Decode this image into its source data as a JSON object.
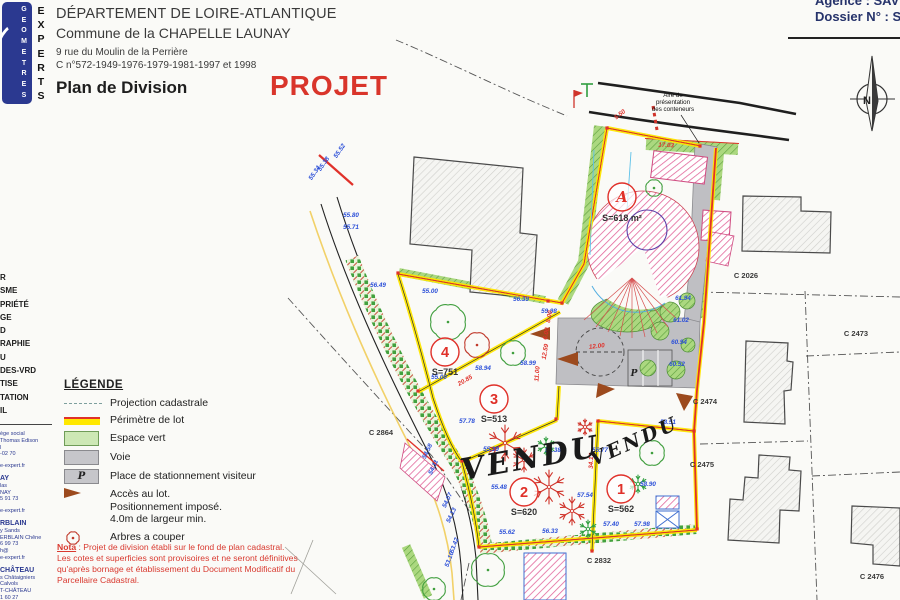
{
  "header": {
    "line1": "DÉPARTEMENT DE LOIRE-ATLANTIQUE",
    "line2": "Commune de la CHAPELLE LAUNAY",
    "line3": "9 rue du Moulin de la Perrière",
    "line4": "C n°572-1949-1976-1979-1981-1997 et 1998",
    "title": "Plan de Division",
    "stamp": "PROJET"
  },
  "corner": {
    "agence": "Agence : SAV",
    "dossier": "Dossier N° : S"
  },
  "logo": {
    "word1": "GEOMETRES",
    "word2": "EXPERTS"
  },
  "sidebar": {
    "services": [
      "R",
      "SME",
      "PRIÉTÉ",
      "GE",
      "D",
      "RAPHIE",
      "U",
      "DES-VRD",
      "TISE",
      "TATION",
      "IL"
    ],
    "addresses": [
      {
        "t": "ège social"
      },
      {
        "t": "Thomas Edison"
      },
      {
        "t": "l"
      },
      {
        "t": "-02 70"
      },
      {
        "t": ""
      },
      {
        "t": "e-expert.fr"
      },
      {
        "t": "AY",
        "b": true
      },
      {
        "t": "las"
      },
      {
        "t": "NAY"
      },
      {
        "t": "5 91 73"
      },
      {
        "t": ""
      },
      {
        "t": "e-expert.fr"
      },
      {
        "t": "RBLAIN",
        "b": true
      },
      {
        "t": "y Sands"
      },
      {
        "t": "ERBLAIN Chêne"
      },
      {
        "t": "6 99 73"
      },
      {
        "t": "h@"
      },
      {
        "t": "e-expert.fr"
      },
      {
        "t": "CHÂTEAU",
        "b": true
      },
      {
        "t": "s Châtaigniers"
      },
      {
        "t": "Calvols"
      },
      {
        "t": "T-CHÂTEAU"
      },
      {
        "t": "1 60 27"
      },
      {
        "t": "@"
      },
      {
        "t": "expert.fr"
      }
    ]
  },
  "legend": {
    "title": "LÉGENDE",
    "items": [
      {
        "symbol": "dash",
        "label": "Projection cadastrale"
      },
      {
        "symbol": "yellow",
        "label": "Périmètre de lot"
      },
      {
        "symbol": "green",
        "label": "Espace vert"
      },
      {
        "symbol": "gray",
        "label": "Voie"
      },
      {
        "symbol": "park",
        "symbol_text": "P",
        "label": "Place de stationnement visiteur"
      },
      {
        "symbol": "arrow",
        "label": "Accès au lot.\nPositionnement imposé.\n4.0m de largeur min."
      },
      {
        "symbol": "tree",
        "label": "Arbres a couper"
      }
    ]
  },
  "nota": {
    "label": "Nota",
    "text": " : Projet de division établi sur le fond de plan cadastral.\nLes cotes et superficies sont provisoires et ne seront définitives\nqu'après bornage et établissement du Document Modificatif du\nParcellaire Cadastral."
  },
  "compass": {
    "letter": "N"
  },
  "map": {
    "lots": [
      {
        "name": "A",
        "area": "S=618 m²",
        "cx": 622,
        "cy": 197,
        "r": 14,
        "ax": 622,
        "ay": 221,
        "italic": true
      },
      {
        "name": "4",
        "area": "S=751",
        "cx": 445,
        "cy": 352,
        "r": 14,
        "ax": 445,
        "ay": 375
      },
      {
        "name": "3",
        "area": "S=513",
        "cx": 494,
        "cy": 399,
        "r": 14,
        "ax": 494,
        "ay": 422
      },
      {
        "name": "2",
        "area": "S=620",
        "cx": 524,
        "cy": 492,
        "r": 14,
        "ax": 524,
        "ay": 515
      },
      {
        "name": "1",
        "area": "S=562",
        "cx": 621,
        "cy": 489,
        "r": 14,
        "ax": 621,
        "ay": 512
      }
    ],
    "vendu": [
      {
        "t": "VENDU",
        "x": 532,
        "y": 468,
        "rot": -10,
        "size": 30
      },
      {
        "t": "VENDU",
        "x": 637,
        "y": 447,
        "rot": -24,
        "size": 19
      }
    ],
    "parcels": [
      {
        "t": "C 2026",
        "x": 746,
        "y": 278
      },
      {
        "t": "C 2473",
        "x": 856,
        "y": 336
      },
      {
        "t": "C 2474",
        "x": 705,
        "y": 404
      },
      {
        "t": "C 2475",
        "x": 702,
        "y": 467
      },
      {
        "t": "C 2476",
        "x": 872,
        "y": 579
      },
      {
        "t": "C 2864",
        "x": 381,
        "y": 435
      },
      {
        "t": "C 2832",
        "x": 599,
        "y": 563
      }
    ],
    "containers_note": {
      "lines": [
        "Aire de",
        "présentation",
        "des conteneurs"
      ],
      "x": 673,
      "y": 97
    },
    "parking_letter": "P",
    "elevations": [
      {
        "t": "55.00",
        "x": 430,
        "y": 293
      },
      {
        "t": "56.39",
        "x": 521,
        "y": 301
      },
      {
        "t": "56.49",
        "x": 378,
        "y": 287
      },
      {
        "t": "58.94",
        "x": 483,
        "y": 370
      },
      {
        "t": "55.00",
        "x": 439,
        "y": 379
      },
      {
        "t": "58.99",
        "x": 528,
        "y": 365
      },
      {
        "t": "59.98",
        "x": 549,
        "y": 313
      },
      {
        "t": "57.78",
        "x": 467,
        "y": 423
      },
      {
        "t": "55.39",
        "x": 491,
        "y": 451
      },
      {
        "t": "55.38",
        "x": 553,
        "y": 452
      },
      {
        "t": "55.77",
        "x": 600,
        "y": 452
      },
      {
        "t": "55.48",
        "x": 499,
        "y": 489
      },
      {
        "t": "57.54",
        "x": 585,
        "y": 497
      },
      {
        "t": "58.90",
        "x": 648,
        "y": 486
      },
      {
        "t": "58.51",
        "x": 668,
        "y": 424
      },
      {
        "t": "55.62",
        "x": 507,
        "y": 534
      },
      {
        "t": "56.33",
        "x": 550,
        "y": 533
      },
      {
        "t": "57.40",
        "x": 611,
        "y": 526
      },
      {
        "t": "57.98",
        "x": 642,
        "y": 526
      },
      {
        "t": "61.94",
        "x": 683,
        "y": 300
      },
      {
        "t": "61.02",
        "x": 681,
        "y": 322
      },
      {
        "t": "60.94",
        "x": 679,
        "y": 344
      },
      {
        "t": "60.52",
        "x": 677,
        "y": 366
      },
      {
        "t": "55.80",
        "x": 351,
        "y": 217
      },
      {
        "t": "55.71",
        "x": 351,
        "y": 229
      },
      {
        "t": "55.34",
        "x": 316,
        "y": 174,
        "r": -55
      },
      {
        "t": "55.38",
        "x": 325,
        "y": 165,
        "r": -55
      },
      {
        "t": "55.52",
        "x": 341,
        "y": 152,
        "r": -55
      },
      {
        "t": "54.58",
        "x": 429,
        "y": 452,
        "r": -65
      },
      {
        "t": "54.11",
        "x": 435,
        "y": 468,
        "r": -65
      },
      {
        "t": "54.07",
        "x": 449,
        "y": 501,
        "r": -65
      },
      {
        "t": "54.13",
        "x": 453,
        "y": 516,
        "r": -65
      },
      {
        "t": "53.42",
        "x": 456,
        "y": 546,
        "r": -70
      },
      {
        "t": "53.16",
        "x": 451,
        "y": 560,
        "r": -70
      }
    ],
    "dims": [
      {
        "t": "17.03",
        "x": 666,
        "y": 147,
        "r": 3
      },
      {
        "t": "5.50",
        "x": 621,
        "y": 116,
        "r": -38
      },
      {
        "t": "8.00",
        "x": 551,
        "y": 317,
        "r": -80
      },
      {
        "t": "6.00",
        "x": 548,
        "y": 334,
        "r": -80
      },
      {
        "t": "12.59",
        "x": 547,
        "y": 352,
        "r": -80
      },
      {
        "t": "11.00",
        "x": 539,
        "y": 374,
        "r": -85
      },
      {
        "t": "20.85",
        "x": 466,
        "y": 382,
        "r": -30
      },
      {
        "t": "34.17",
        "x": 593,
        "y": 461,
        "r": -88
      },
      {
        "t": "12.00",
        "x": 597,
        "y": 348,
        "r": -6
      }
    ],
    "trees": {
      "green_flowers": [
        [
          448,
          322,
          17
        ],
        [
          513,
          353,
          12
        ],
        [
          654,
          188,
          8
        ],
        [
          652,
          453,
          12
        ],
        [
          488,
          570,
          16
        ],
        [
          434,
          589,
          11
        ]
      ],
      "red_flowers": [
        [
          477,
          345,
          12
        ]
      ],
      "red_snow": [
        [
          505,
          443,
          18
        ],
        [
          524,
          460,
          12
        ],
        [
          549,
          487,
          17
        ],
        [
          572,
          511,
          14
        ],
        [
          585,
          427,
          8
        ]
      ],
      "green_snow": [
        [
          546,
          446,
          9
        ],
        [
          638,
          484,
          9
        ],
        [
          588,
          529,
          9
        ]
      ]
    },
    "colors": {
      "perimeter_yellow": "#ffe600",
      "perimeter_red": "#e0312a",
      "espace_vert": "#abd87f",
      "voie_gray": "#bfbfc3",
      "elevation_blue": "#2b4fd8",
      "access_brown": "#9c4a1e",
      "hatch_pink": "#e2679b"
    }
  }
}
